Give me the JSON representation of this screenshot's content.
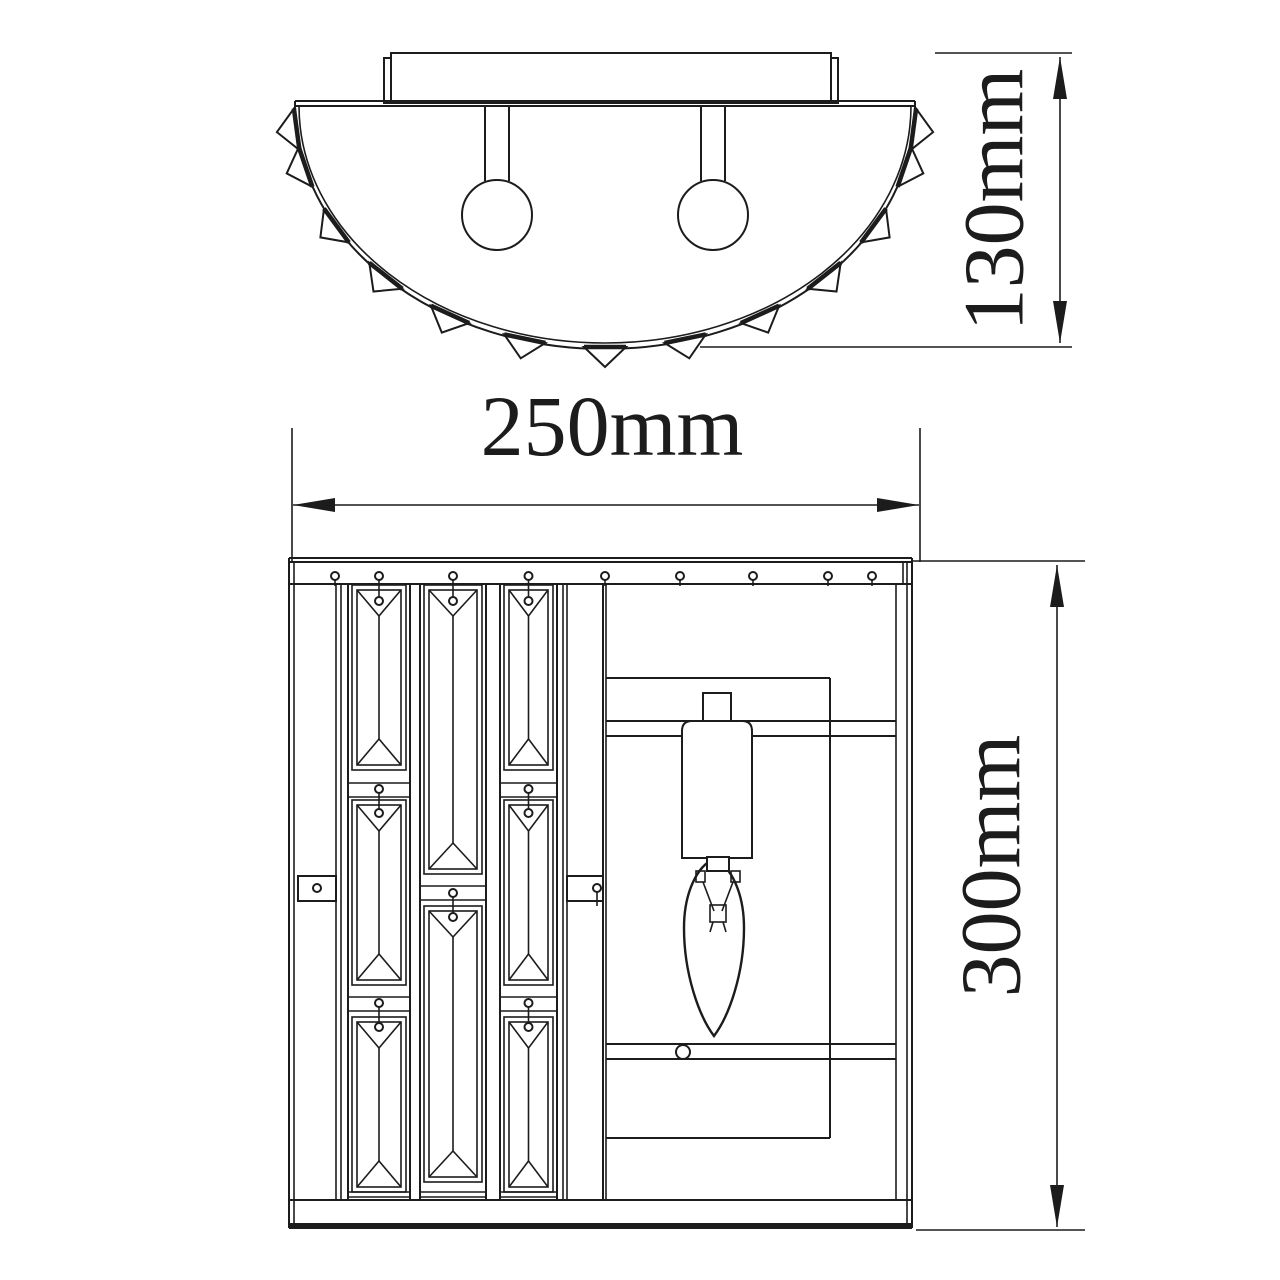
{
  "colors": {
    "line": "#1c1c1c",
    "background": "#ffffff"
  },
  "dimensions": {
    "fixture_width": "250mm",
    "fixture_depth": "130mm",
    "fixture_height": "300mm"
  }
}
